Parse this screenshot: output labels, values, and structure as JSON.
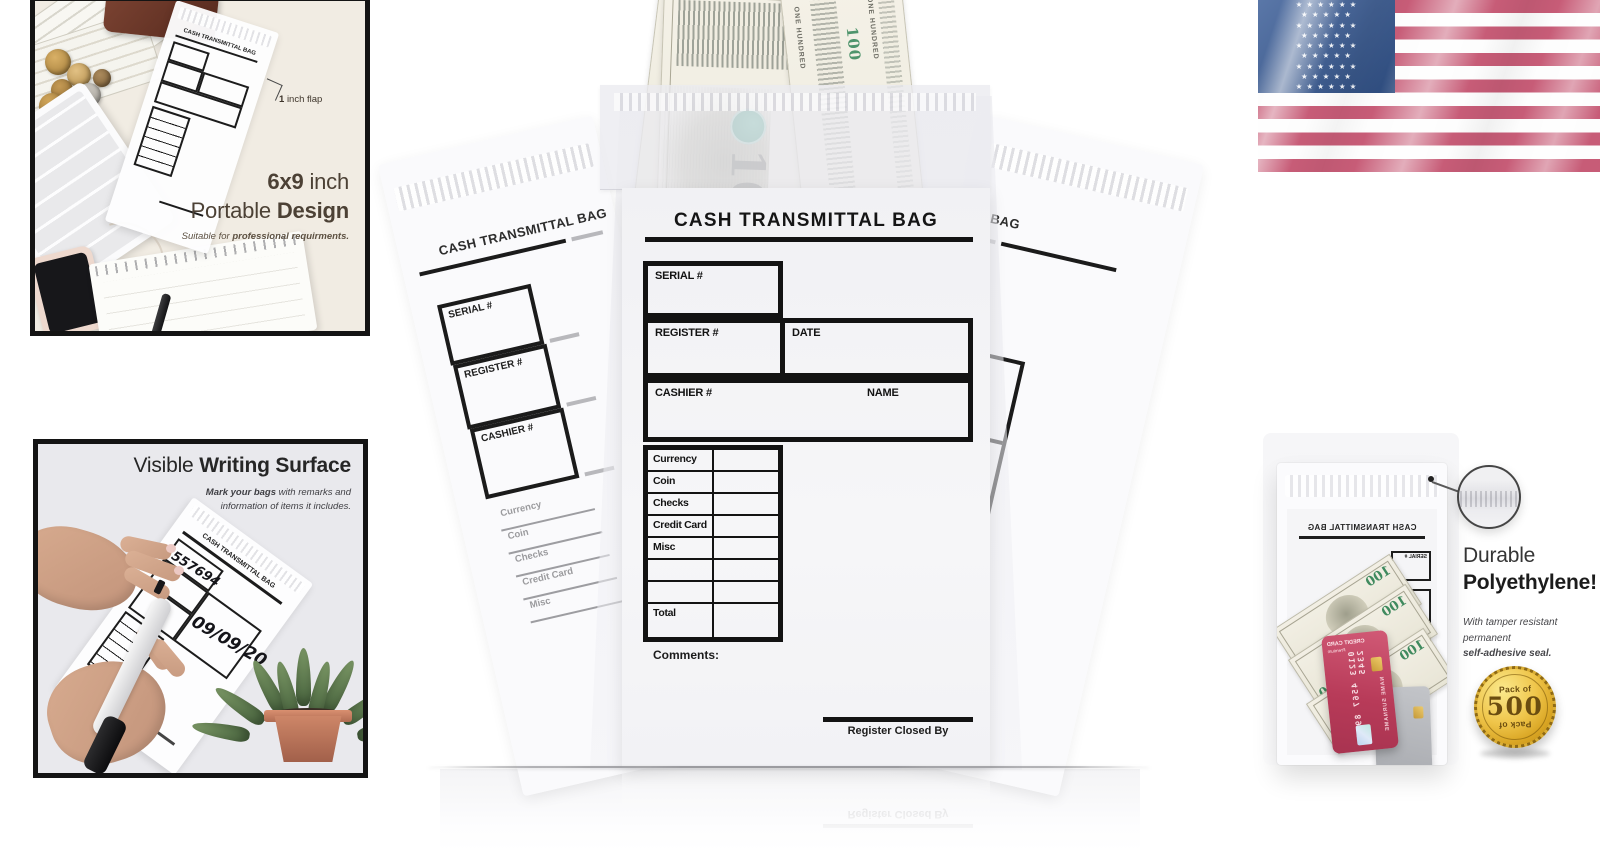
{
  "panel_portable": {
    "flap_note_bold": "1",
    "flap_note_rest": "inch flap",
    "headline_bold_1": "6x9",
    "headline_light_1": "inch",
    "headline_light_2": "Portable",
    "headline_bold_2": "Design",
    "subtitle_prefix": "Suitable for ",
    "subtitle_bold": "professional requirments."
  },
  "panel_writing": {
    "title_light": "Visible",
    "title_bold": "Writing Surface",
    "subtitle_bold": "Mark your bags",
    "subtitle_rest_line1": "with remarks and",
    "subtitle_line2": "information of items it includes.",
    "handwritten_serial": "557694",
    "handwritten_date": "09/09/20"
  },
  "center_bag": {
    "title": "CASH TRANSMITTAL BAG",
    "form": {
      "serial_label": "SERIAL #",
      "register_label": "REGISTER #",
      "date_label": "DATE",
      "cashier_label": "CASHIER #",
      "name_label": "NAME",
      "rows": [
        "Currency",
        "Coin",
        "Checks",
        "Credit Card",
        "Misc",
        "",
        "",
        "Total"
      ],
      "comments_label": "Comments:",
      "closed_by_label": "Register Closed By"
    },
    "bill": {
      "denomination": "100",
      "serial": "KB 7401671",
      "edge_text": "ONE HUNDRED"
    }
  },
  "flag": {
    "star_row_6": "★ ★ ★ ★ ★ ★",
    "star_row_5": "★ ★ ★ ★ ★",
    "colors": {
      "red": "#c75c77",
      "blue": "#2c4a7c",
      "white": "#fdfdfd"
    }
  },
  "panel_durable": {
    "heading_line1": "Durable",
    "heading_line2": "Polyethylene!",
    "subtitle_line1": "With tamper resistant permanent",
    "subtitle_line2": "self-adhesive seal.",
    "badge_top": "Pack of",
    "badge_value": "500",
    "badge_bottom": "Pack of",
    "card": {
      "label": "CREDIT CARD",
      "tier": "Premium",
      "number": "0123 4567 8901 2345",
      "holder": "NAME SURNAME"
    }
  }
}
